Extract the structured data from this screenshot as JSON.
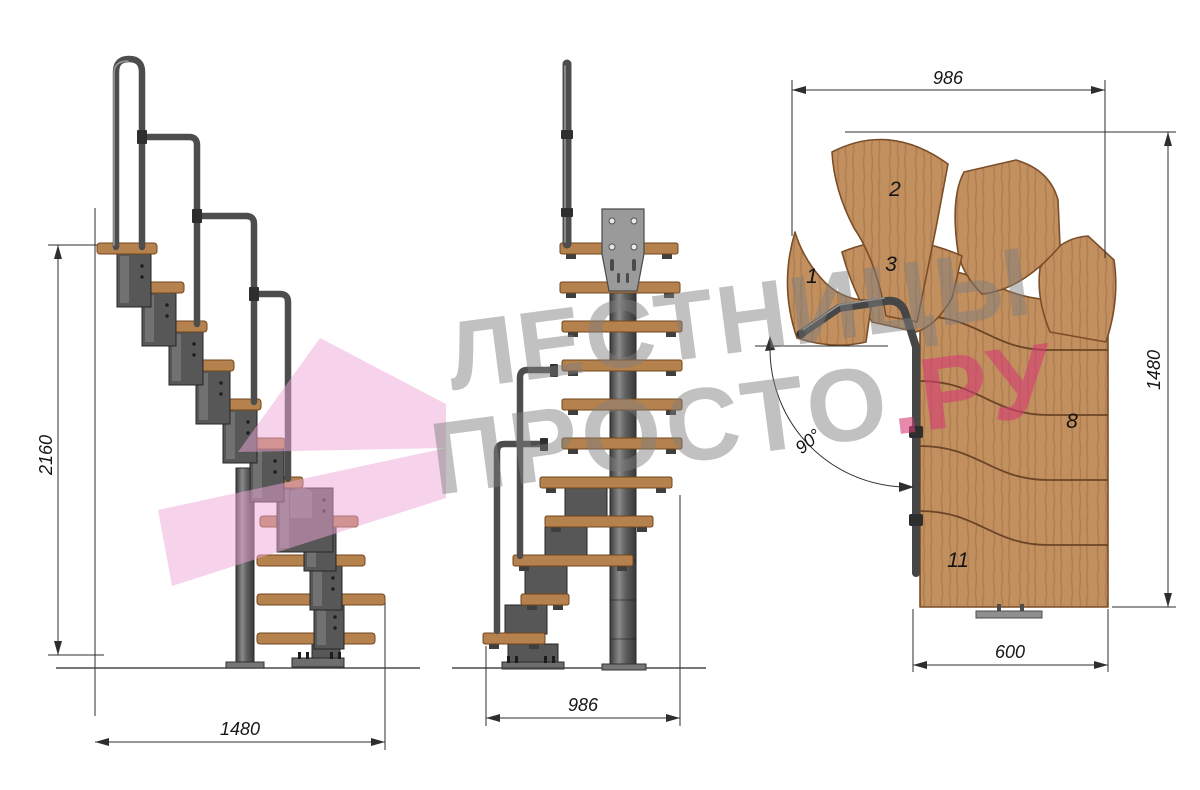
{
  "watermark": {
    "line1": "ЛЕСТНИЦЫ",
    "line2": "ПРОСТО",
    "accent": ".РУ"
  },
  "side_view": {
    "height_mm": "2160",
    "width_mm": "1480"
  },
  "front_view": {
    "width_mm": "986"
  },
  "plan_view": {
    "width_mm": "986",
    "depth_mm": "1480",
    "lower_flight_width_mm": "600",
    "turn_angle": "90°",
    "step_numbers": [
      "1",
      "2",
      "3",
      "8",
      "11"
    ]
  },
  "colors": {
    "wood": "#c28f5f",
    "metal": "#4f4f4f",
    "watermark_gray": "#8a8a8a",
    "watermark_pink": "#d63c74",
    "ribbon_pink": "#f0a6d8"
  }
}
